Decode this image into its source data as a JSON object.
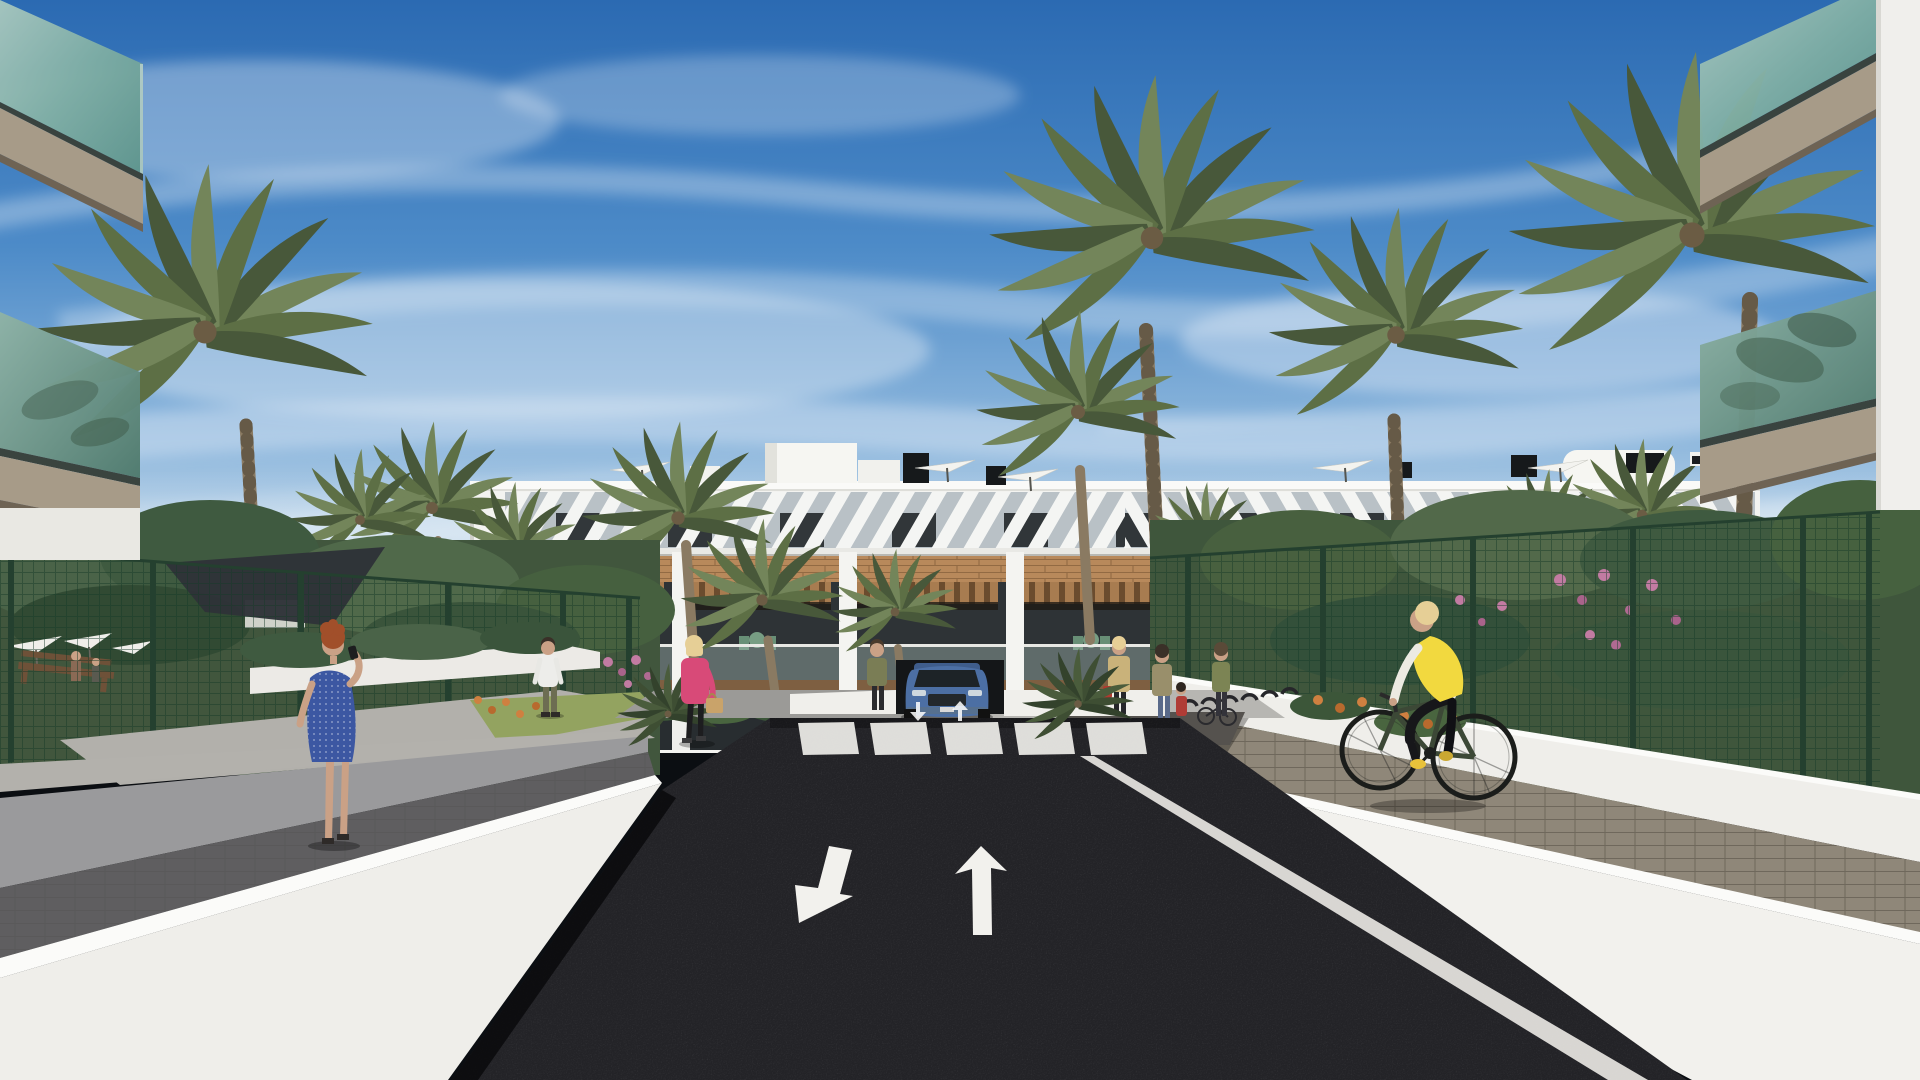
{
  "meta": {
    "type": "3d-architectural-render",
    "title": "Residential complex street view",
    "description": "Sunny 3D rendering of a modern white apartment complex with timber accents and rooftop terraces, an entrance road in dark asphalt with painted direction arrows and a zebra crosswalk, an underground garage with a blue SUV, palm trees, landscaped gardens behind green mesh fences, several pedestrians and a cyclist in a yellow vest."
  },
  "palette": {
    "sky-top": "#2b6ab2",
    "sky-mid": "#4d8bc8",
    "sky-low": "#8fb8dd",
    "sky-horizon": "#e2ecf3",
    "cloud": "#ffffff",
    "facade-white": "#f3f3f0",
    "facade-shadow": "#dededa",
    "louvre-bg": "#b9c1c6",
    "window-dark": "#262b2e",
    "wood-brick": "#b8895b",
    "wood-brick-joint": "#926a43",
    "pergola-wood": "#a87c50",
    "pergola-shadow": "#241f19",
    "balcony-glass": "#a9c0ba",
    "planter-wood": "#7e5f41",
    "glass-teal": "#8fb7ac",
    "glass-teal-deep": "#5d948b",
    "soffit-taupe": "#a79b88",
    "soffit-dark": "#6e6354",
    "asphalt": "#232327",
    "road-line": "#eceae6",
    "crosswalk": "#e9e8e4",
    "plaza-grey": "#b7b6b2",
    "paver-grey": "#aba79f",
    "paver-brown": "#8f8779",
    "wall-white": "#f2f1ed",
    "wall-cap": "#fbfbf9",
    "wall-grey": "#9a9a9c",
    "fence-green": "#24402f",
    "frond-light": "#73855a",
    "frond": "#5d6f45",
    "frond-dark": "#48583a",
    "trunk": "#8a7a62",
    "shrub": "#4a6341",
    "shrub-dark": "#39513a",
    "grass": "#93a360",
    "flower-pink": "#c27ba2",
    "flower-orange": "#cf8040",
    "car-blue": "#4c6fa4",
    "car-glass": "#1d2327",
    "vest-yellow": "#f2d93f",
    "dress-blue": "#3c57a2",
    "jacket-pink": "#d84a78",
    "hair-auburn": "#a14f2a",
    "hair-blonde": "#e6cf96",
    "skin": "#caa186",
    "bike-frame": "#3c4836",
    "sail-grey": "#2e3338"
  },
  "scene": {
    "sky": {
      "label": "Blue sky with wispy cirrus clouds"
    },
    "building": {
      "label": "Three-storey white apartment block",
      "features": [
        "rooftop terraces with white parasols",
        "diagonal louvre band on top floor",
        "dark ribbon windows",
        "timber-clad band",
        "balconies with wood pergolas, green cafe furniture and glass railings",
        "underground garage ramp"
      ]
    },
    "road": {
      "label": "Dark asphalt entrance road",
      "markings": {
        "arrow_left": "white arrow pointing lower-left",
        "arrow_straight": "white straight-ahead arrow",
        "crosswalk_stripes": 5,
        "edge_lines": "white edge lines on both sides",
        "mini_arrows": 2
      }
    },
    "vehicle": {
      "label": "Blue SUV at underground garage ramp"
    },
    "people": [
      {
        "label": "Red-haired woman in blue polka-dot dress talking on phone",
        "position": "left walkway"
      },
      {
        "label": "Man in white t-shirt",
        "position": "left garden path"
      },
      {
        "label": "Blonde woman in pink jacket with tan handbag",
        "position": "center path"
      },
      {
        "label": "Woman in olive jacket",
        "position": "left of garage ramp"
      },
      {
        "label": "Woman in tan coat with red bag",
        "position": "right plaza"
      },
      {
        "label": "Mother with small child",
        "position": "right plaza"
      },
      {
        "label": "Person at bicycle racks",
        "position": "right plaza"
      },
      {
        "label": "Cyclist in yellow vest on dark green bicycle",
        "position": "right walkway"
      },
      {
        "label": "Distant figures at the pool deck",
        "position": "behind left fence"
      }
    ],
    "landscape": {
      "palm_count": 16,
      "pool_area": "pool deck with white parasols, dark shade sail and wooden bench behind green mesh fence",
      "flowers": [
        "pink",
        "orange"
      ],
      "fences": "dark green wire mesh with posts"
    },
    "furniture": {
      "bike_racks": 6,
      "balcony_furniture": "green cafe tables and chairs"
    }
  }
}
